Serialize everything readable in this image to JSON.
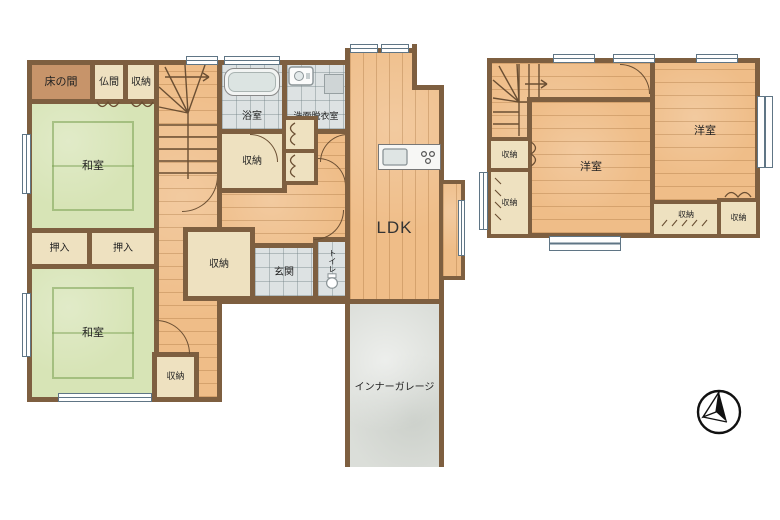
{
  "floor1": {
    "tokonoma": "床の間",
    "butsuma": "仏間",
    "storage_top": "収納",
    "washitsu_1": "和室",
    "oshiire_1": "押入",
    "oshiire_2": "押入",
    "washitsu_2": "和室",
    "storage_sw": "収納",
    "bathroom": "浴室",
    "washroom": "洗面脱衣室",
    "storage_center": "収納",
    "storage_hall": "収納",
    "genkan": "玄関",
    "toilet": "トイレ",
    "ldk": "LDK",
    "garage": "インナーガレージ"
  },
  "floor2": {
    "storage_a": "収納",
    "storage_b": "収納",
    "bedroom_left": "洋室",
    "bedroom_right": "洋室",
    "storage_c": "収納",
    "storage_d": "収納"
  },
  "icons": {
    "compass": "north-arrow-compass"
  },
  "colors": {
    "wall": "#7e5f40",
    "wood": "#efbd88",
    "tatami": "#d7e4b6",
    "tile": "#dde2e3",
    "closet_cream": "#eee1c0",
    "tokonoma_fill": "#c7946a",
    "garage_gray": "#dbded9",
    "window_frame": "#5f7585"
  }
}
